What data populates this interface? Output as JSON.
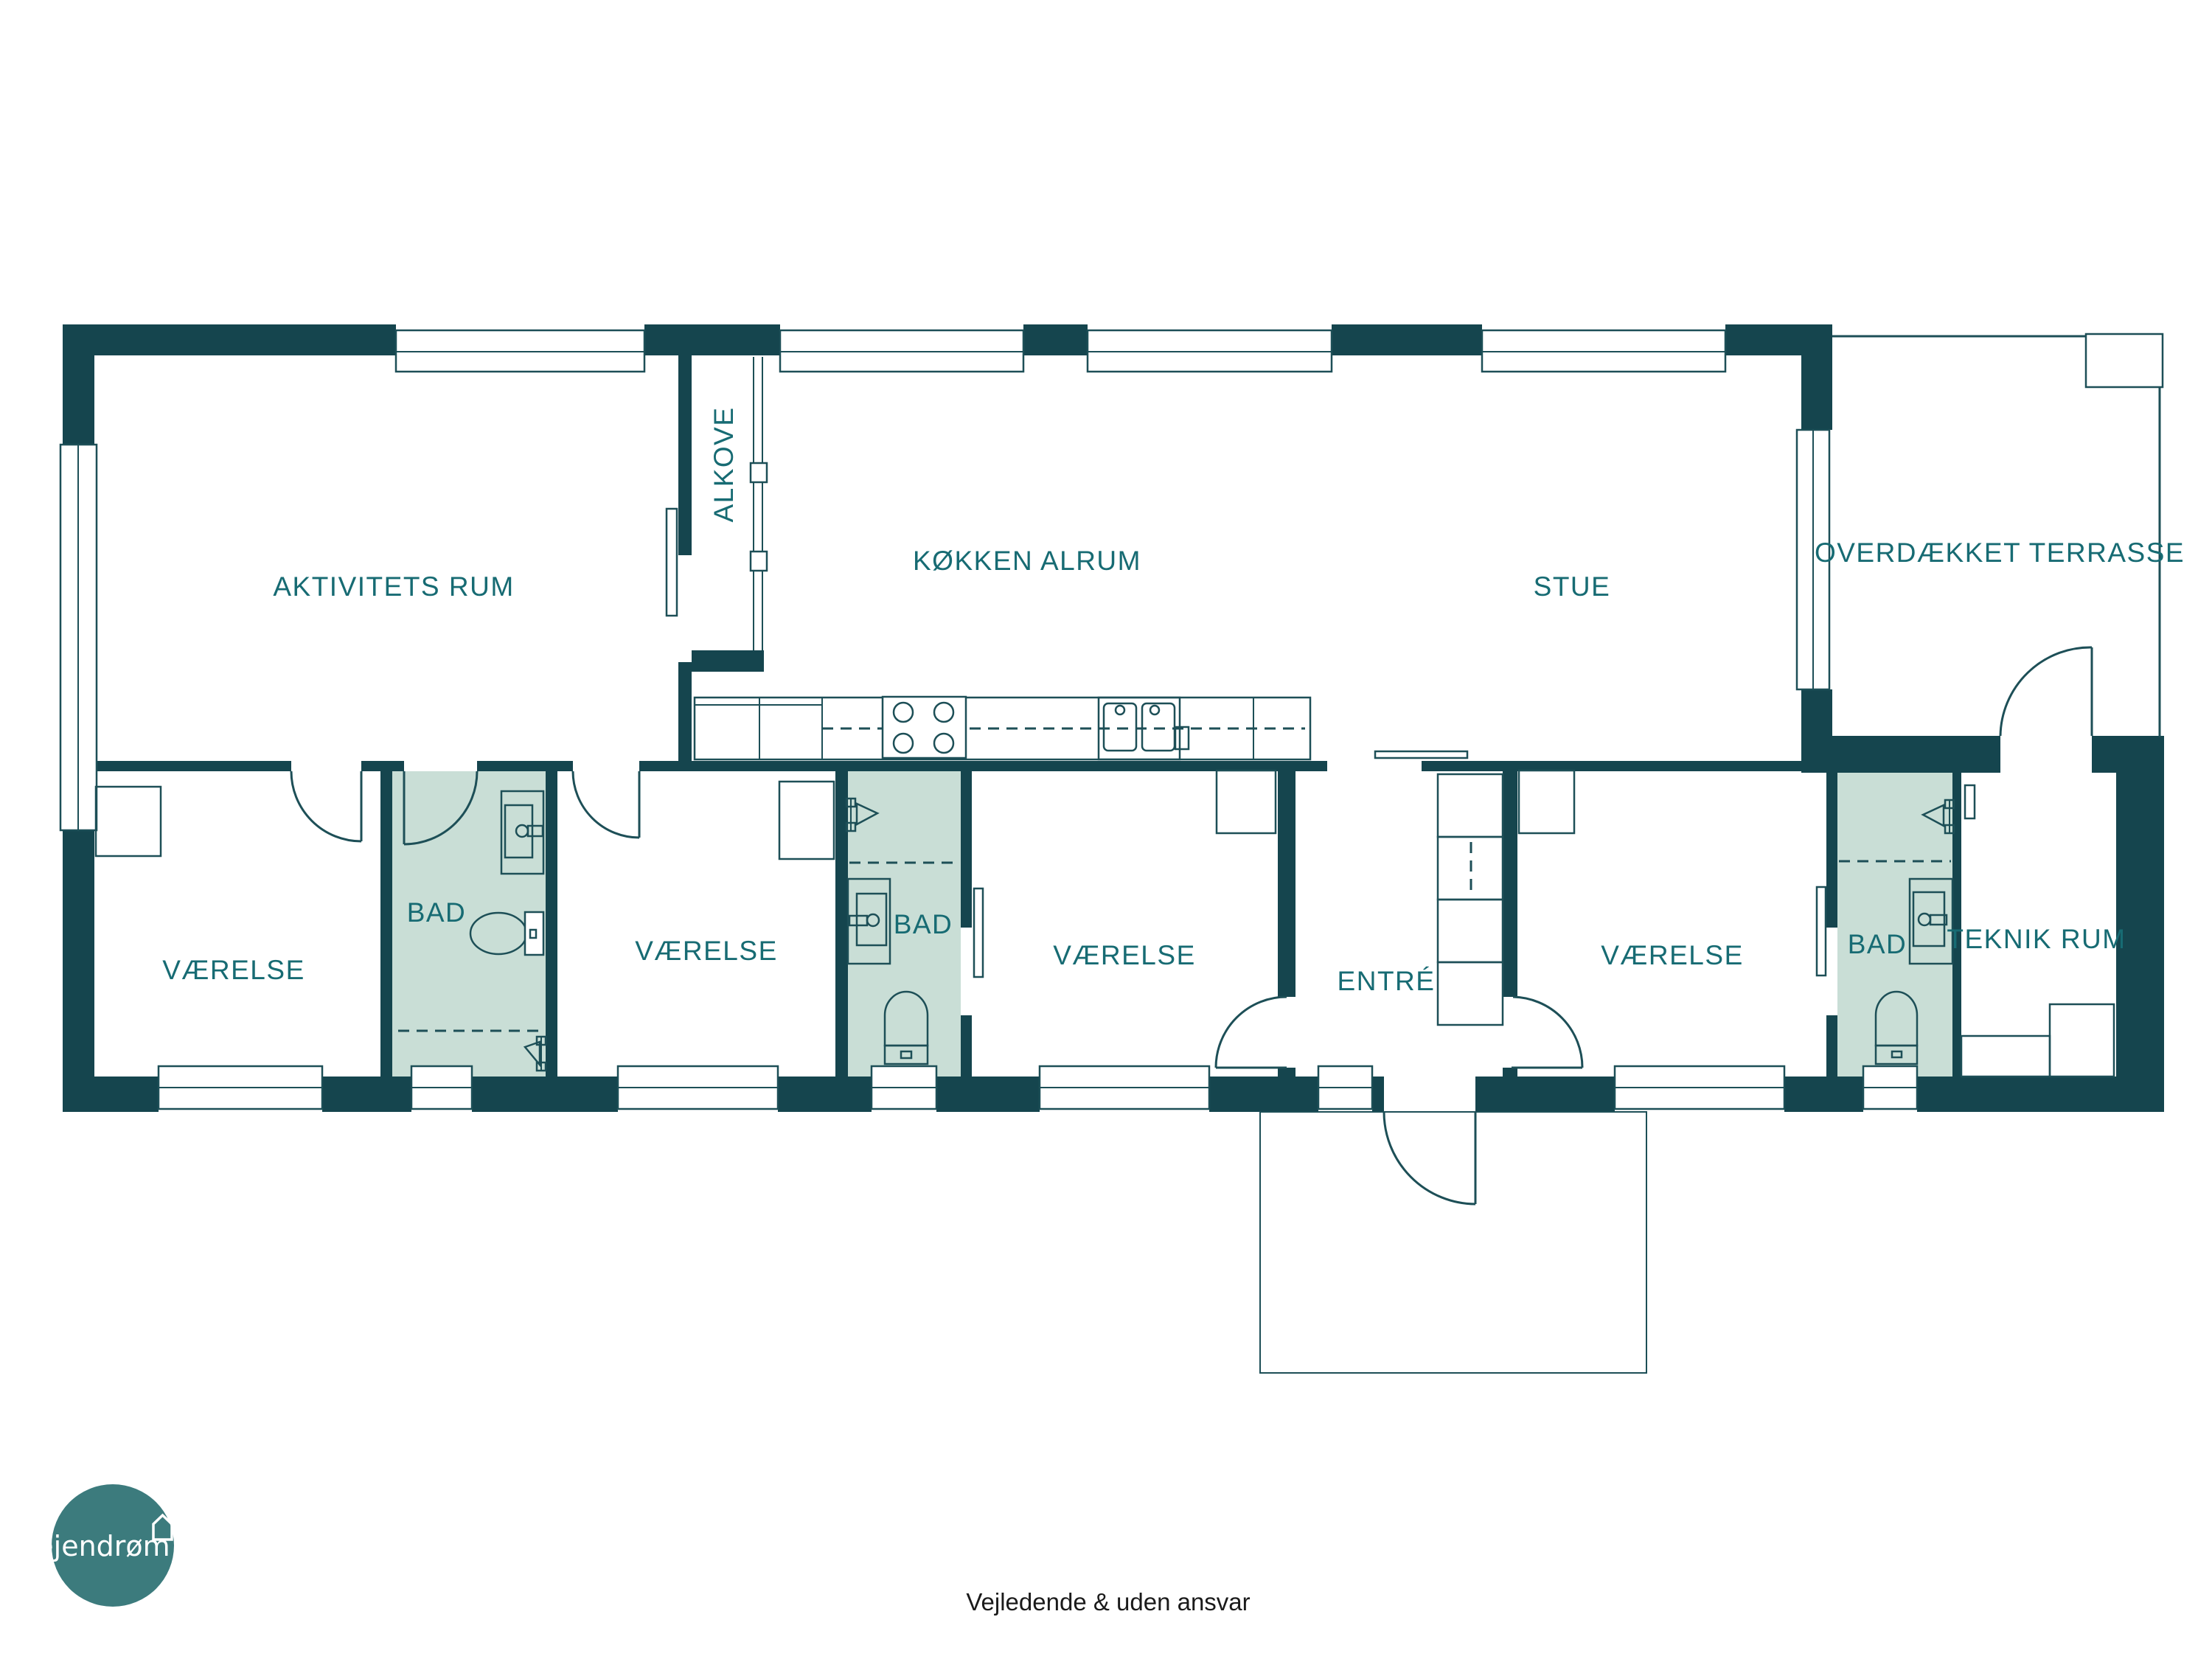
{
  "colors": {
    "wall": "#15454E",
    "line": "#1D4F57",
    "bathroom_fill": "#C9DED6",
    "room_label": "#176B73",
    "logo_circle": "#3C7B7D",
    "footer_text": "#1A1A1A"
  },
  "rooms": {
    "aktivitets_rum": "AKTIVITETS RUM",
    "alkove": "ALKOVE",
    "kokken_alrum": "KØKKEN ALRUM",
    "stue": "STUE",
    "overdaekket_terrasse": "OVERDÆKKET TERRASSE",
    "vaerelse_1": "VÆRELSE",
    "bad_1": "BAD",
    "vaerelse_2": "VÆRELSE",
    "bad_2": "BAD",
    "vaerelse_3": "VÆRELSE",
    "entre": "ENTRÉ",
    "vaerelse_4": "VÆRELSE",
    "bad_3": "BAD",
    "teknik_rum": "TEKNIK RUM"
  },
  "logo": {
    "brand": "ejendrøm",
    "icon": "house-outline-icon"
  },
  "footer": {
    "disclaimer": "Vejledende & uden ansvar"
  }
}
